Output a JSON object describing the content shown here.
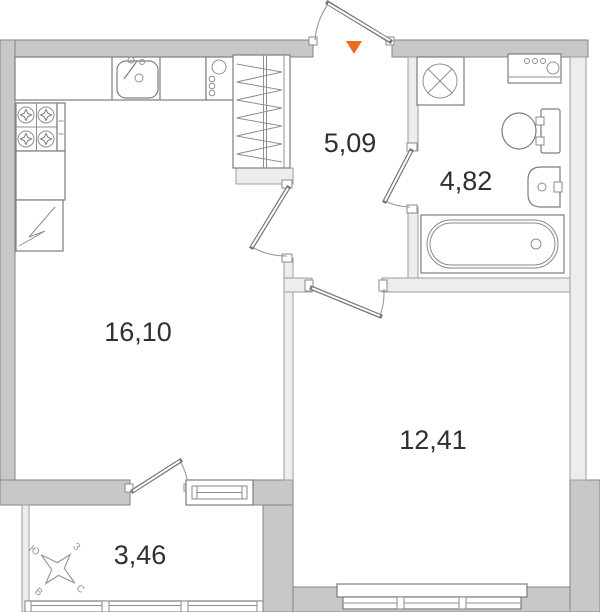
{
  "rooms": {
    "kitchen_living": {
      "label": "16,10"
    },
    "hallway": {
      "label": "5,09"
    },
    "bathroom": {
      "label": "4,82"
    },
    "bedroom": {
      "label": "12,41"
    },
    "balcony": {
      "label": "3,46"
    }
  },
  "compass": {
    "north": "С",
    "south": "Ю",
    "east": "В",
    "west": "З"
  },
  "colors": {
    "entrance_marker": "#ed6c1f",
    "exterior_wall": "#c8c8c8",
    "interior_wall": "#ededed",
    "outline": "#7d7d7d",
    "label_text": "#303030"
  }
}
